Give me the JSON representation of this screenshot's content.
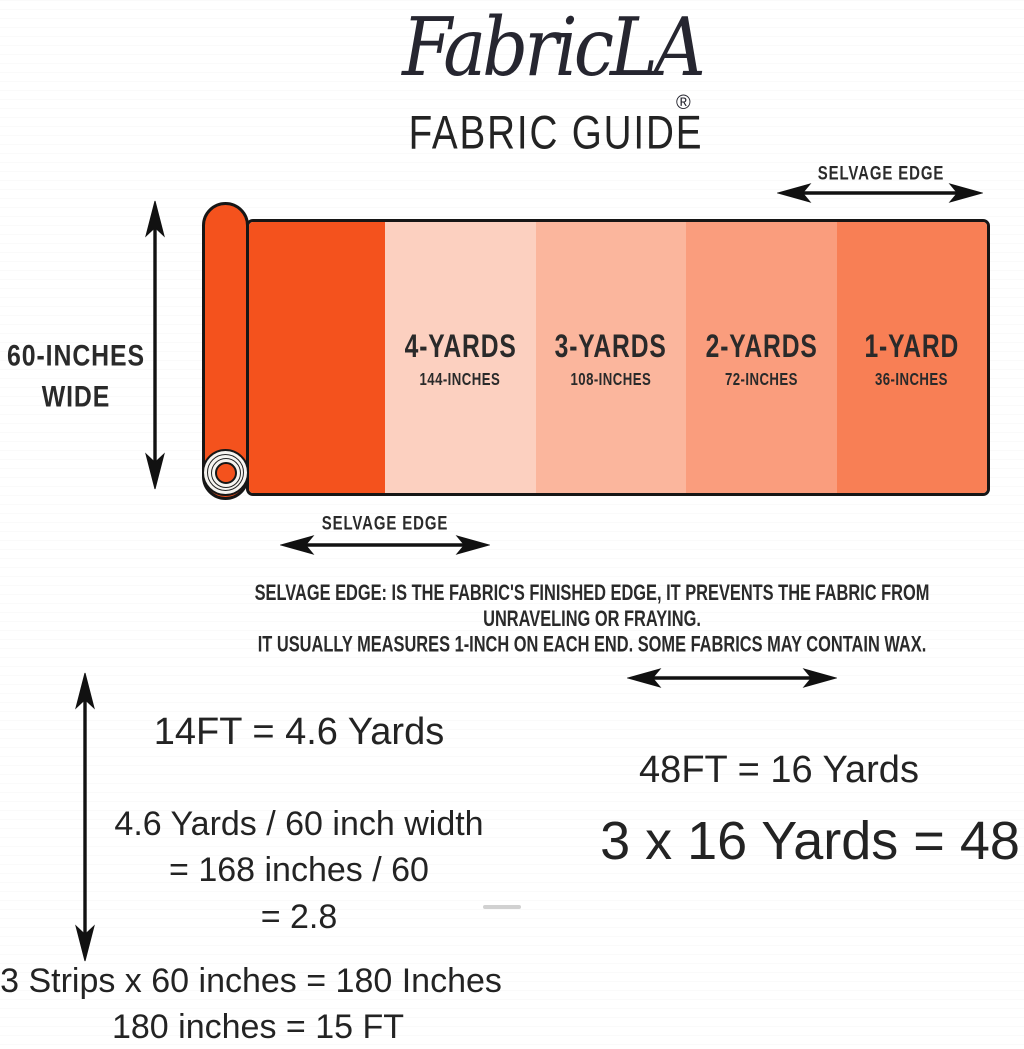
{
  "brand": {
    "logo_text": "FabricLA",
    "registered_mark": "®",
    "title": "FABRIC GUIDE"
  },
  "colors": {
    "roll_orange": "#f4521d",
    "outline": "#161616",
    "text": "#232323"
  },
  "fabric_roll": {
    "width_label_line1": "60-INCHES",
    "width_label_line2": "WIDE",
    "selvage_edge_top": "SELVAGE EDGE",
    "selvage_edge_bottom": "SELVAGE EDGE",
    "sections": [
      {
        "yards": "4-YARDS",
        "inches": "144-INCHES",
        "color": "#fcd0c0"
      },
      {
        "yards": "3-YARDS",
        "inches": "108-INCHES",
        "color": "#fbb69d"
      },
      {
        "yards": "2-YARDS",
        "inches": "72-INCHES",
        "color": "#fa9d7d"
      },
      {
        "yards": "1-YARD",
        "inches": "36-INCHES",
        "color": "#f87f55"
      }
    ]
  },
  "selvage_note": {
    "line1": "SELVAGE EDGE: IS THE FABRIC'S FINISHED EDGE, IT PREVENTS THE FABRIC FROM UNRAVELING OR FRAYING.",
    "line2": "IT USUALLY MEASURES 1-INCH ON EACH END. SOME FABRICS MAY CONTAIN WAX."
  },
  "calculations": {
    "left": {
      "line1": "14FT = 4.6 Yards",
      "line2": "4.6 Yards / 60 inch width",
      "line3": "= 168 inches / 60",
      "line4": "= 2.8"
    },
    "right": {
      "line1": "48FT = 16 Yards",
      "line2": "3 x 16 Yards = 48"
    },
    "bottom": {
      "line1": "3 Strips x 60 inches = 180 Inches",
      "line2": "180 inches = 15 FT"
    }
  }
}
